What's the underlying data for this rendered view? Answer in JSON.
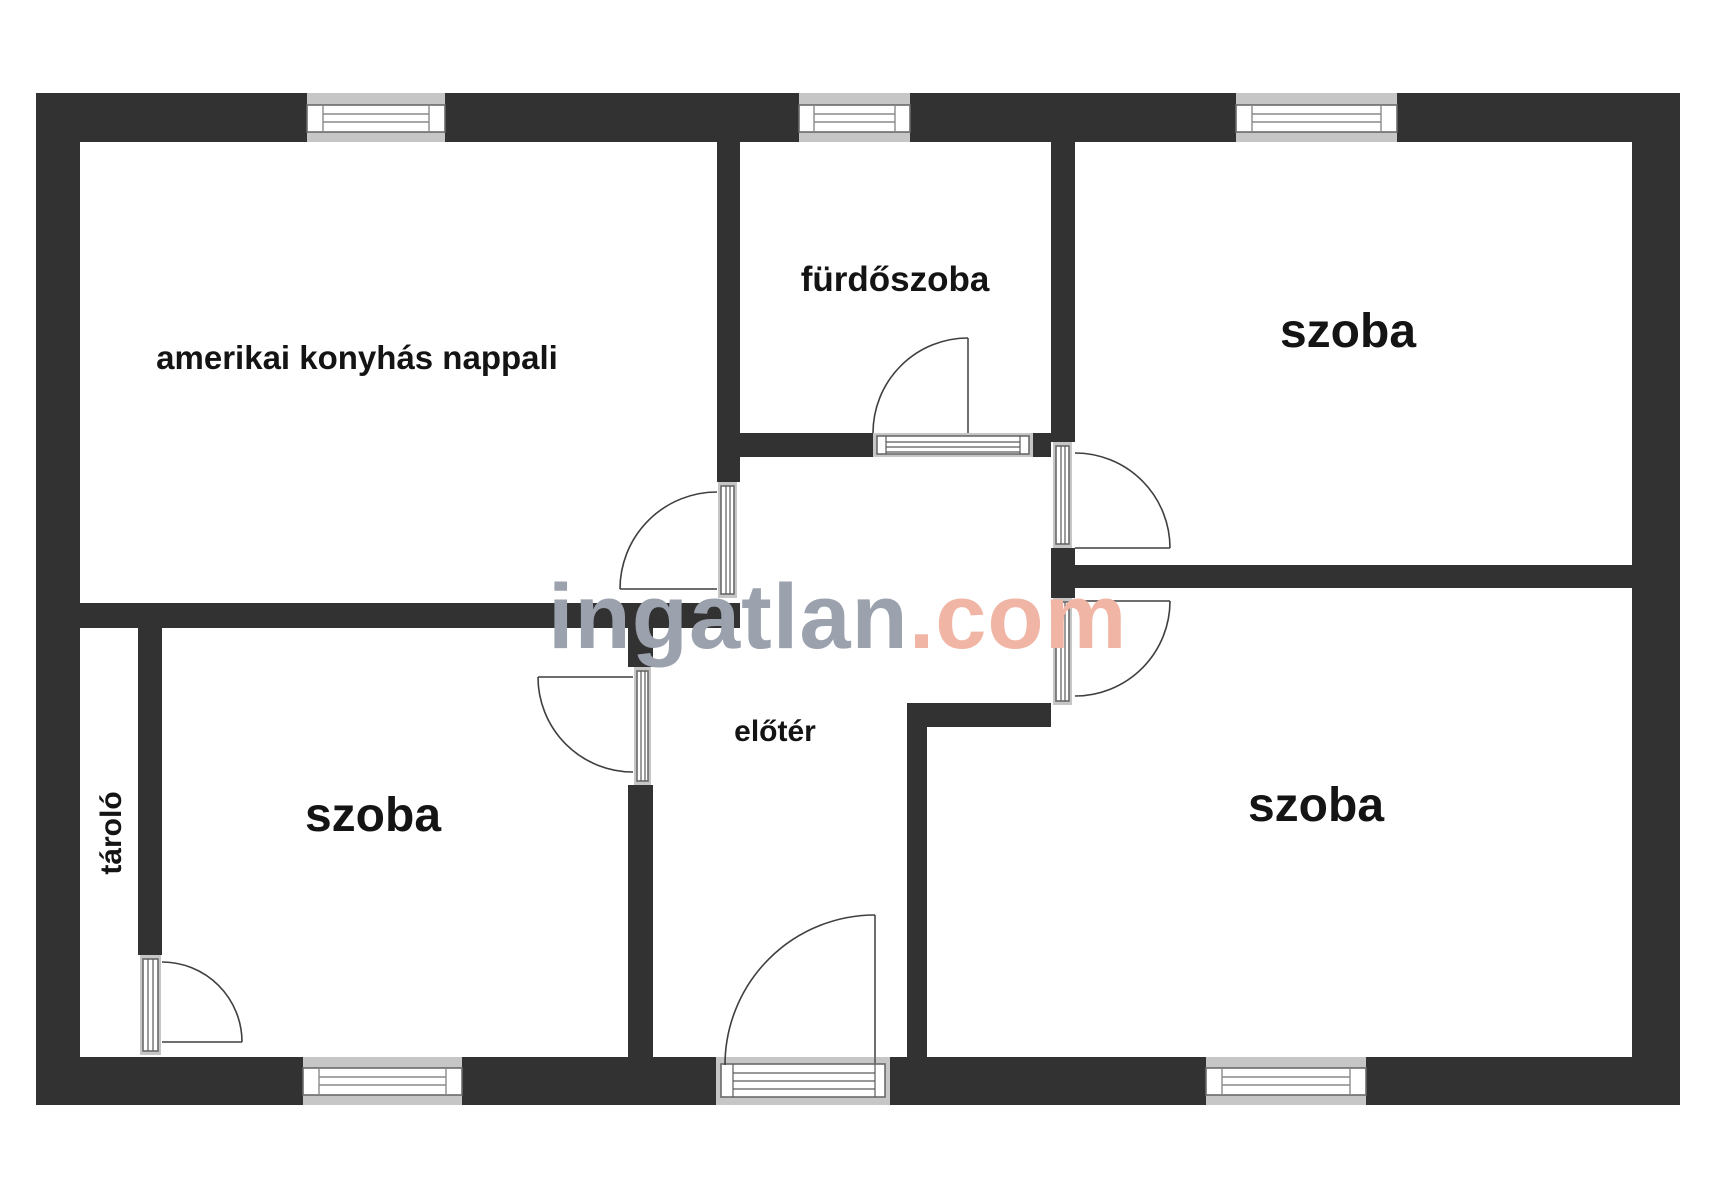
{
  "plan": {
    "watermark": {
      "brand": "ingatlan",
      "suffix": ".com"
    },
    "rooms": {
      "living": {
        "label": "amerikai konyhás nappali"
      },
      "bathroom": {
        "label": "fürdőszoba"
      },
      "room_top_right": {
        "label": "szoba"
      },
      "room_bottom_left": {
        "label": "szoba"
      },
      "room_bottom_right": {
        "label": "szoba"
      },
      "hall": {
        "label": "előtér"
      },
      "storage": {
        "label": "tároló"
      }
    },
    "colors": {
      "wall": "#323232",
      "window_frame": "#c6c6c6",
      "glass_outline": "#6a6a6a",
      "door_arc": "#3f3f3f",
      "label_text": "#141414",
      "watermark_gray": "#9ba1ad",
      "watermark_accent": "#f0b5a4",
      "background": "#ffffff"
    }
  }
}
